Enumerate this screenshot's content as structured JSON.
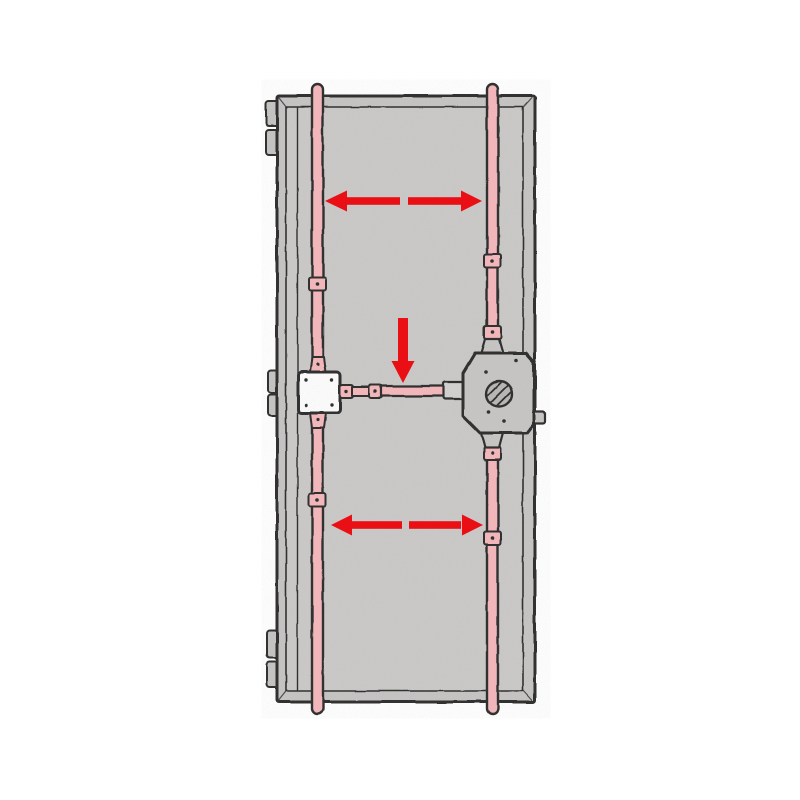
{
  "page": {
    "background": "#ffffff",
    "title": "Door multi-point locking mechanism diagram"
  },
  "colors": {
    "outline": "#2f2f2f",
    "door_frame": "#c6c5c3",
    "door_panel": "#cbcac8",
    "rod": "#f5b8bc",
    "box_white": "#fdfdfd",
    "gearbox": "#c7c6c4",
    "gear_circle": "#b9b8b6",
    "metal_light": "#d3d2d0",
    "arrow_red": "#e90f14"
  },
  "components": {
    "door_leaf": "door leaf, inside view",
    "hinge_knuckles": "three pairs of hinge knuckles on left edge",
    "left_rod": "vertical locking rod, hinge side",
    "right_rod": "vertical locking rod, lock side",
    "rod_guides": "rod guide clips",
    "deflection_box": "square deflection box",
    "drive_rod": "horizontal drive rod with couplers",
    "central_gearbox": "central lock gearbox",
    "follower": "hatched cylinder follower",
    "latch_bolt": "latch bolt on lock edge"
  },
  "annotations": {
    "arrows": [
      {
        "id": "upper-double-arrow",
        "direction": "left-right"
      },
      {
        "id": "center-down-arrow",
        "direction": "down"
      },
      {
        "id": "lower-double-arrow",
        "direction": "left-right"
      }
    ]
  }
}
